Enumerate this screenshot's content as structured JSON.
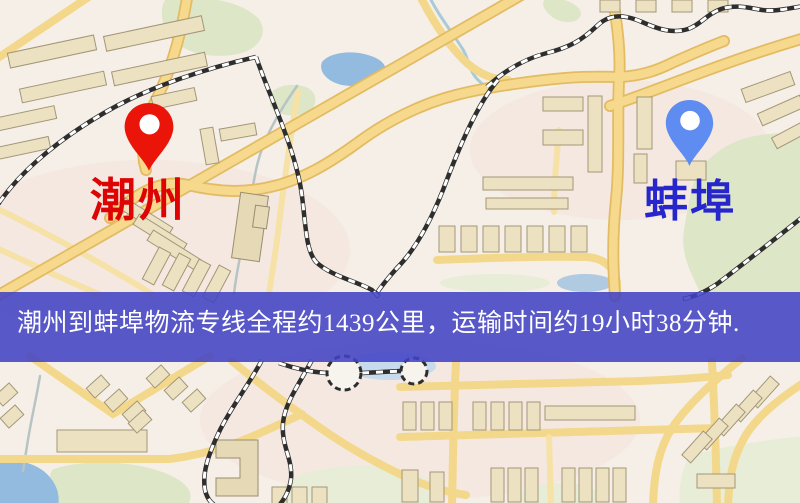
{
  "map": {
    "origin": {
      "name": "潮州",
      "marker_color": "#ea1508",
      "label_color": "#de0404"
    },
    "destination": {
      "name": "蚌埠",
      "marker_color": "#5e8cf0",
      "label_color": "#2626cc"
    },
    "banner": {
      "text": "潮州到蚌埠物流专线全程约1439公里，运输时间约19小时38分钟.",
      "distance_km": "1439",
      "duration": "19小时38分钟",
      "background_color": "#4042c4",
      "text_color": "#ffffff"
    },
    "palette": {
      "land": "#f6efe7",
      "road_major": "#f6d98c",
      "road_casing": "#e2bb62",
      "water": "#93bbdf",
      "park": "#dde6c6",
      "building": "#ece2c2",
      "railway": "#2e2e2e"
    }
  }
}
